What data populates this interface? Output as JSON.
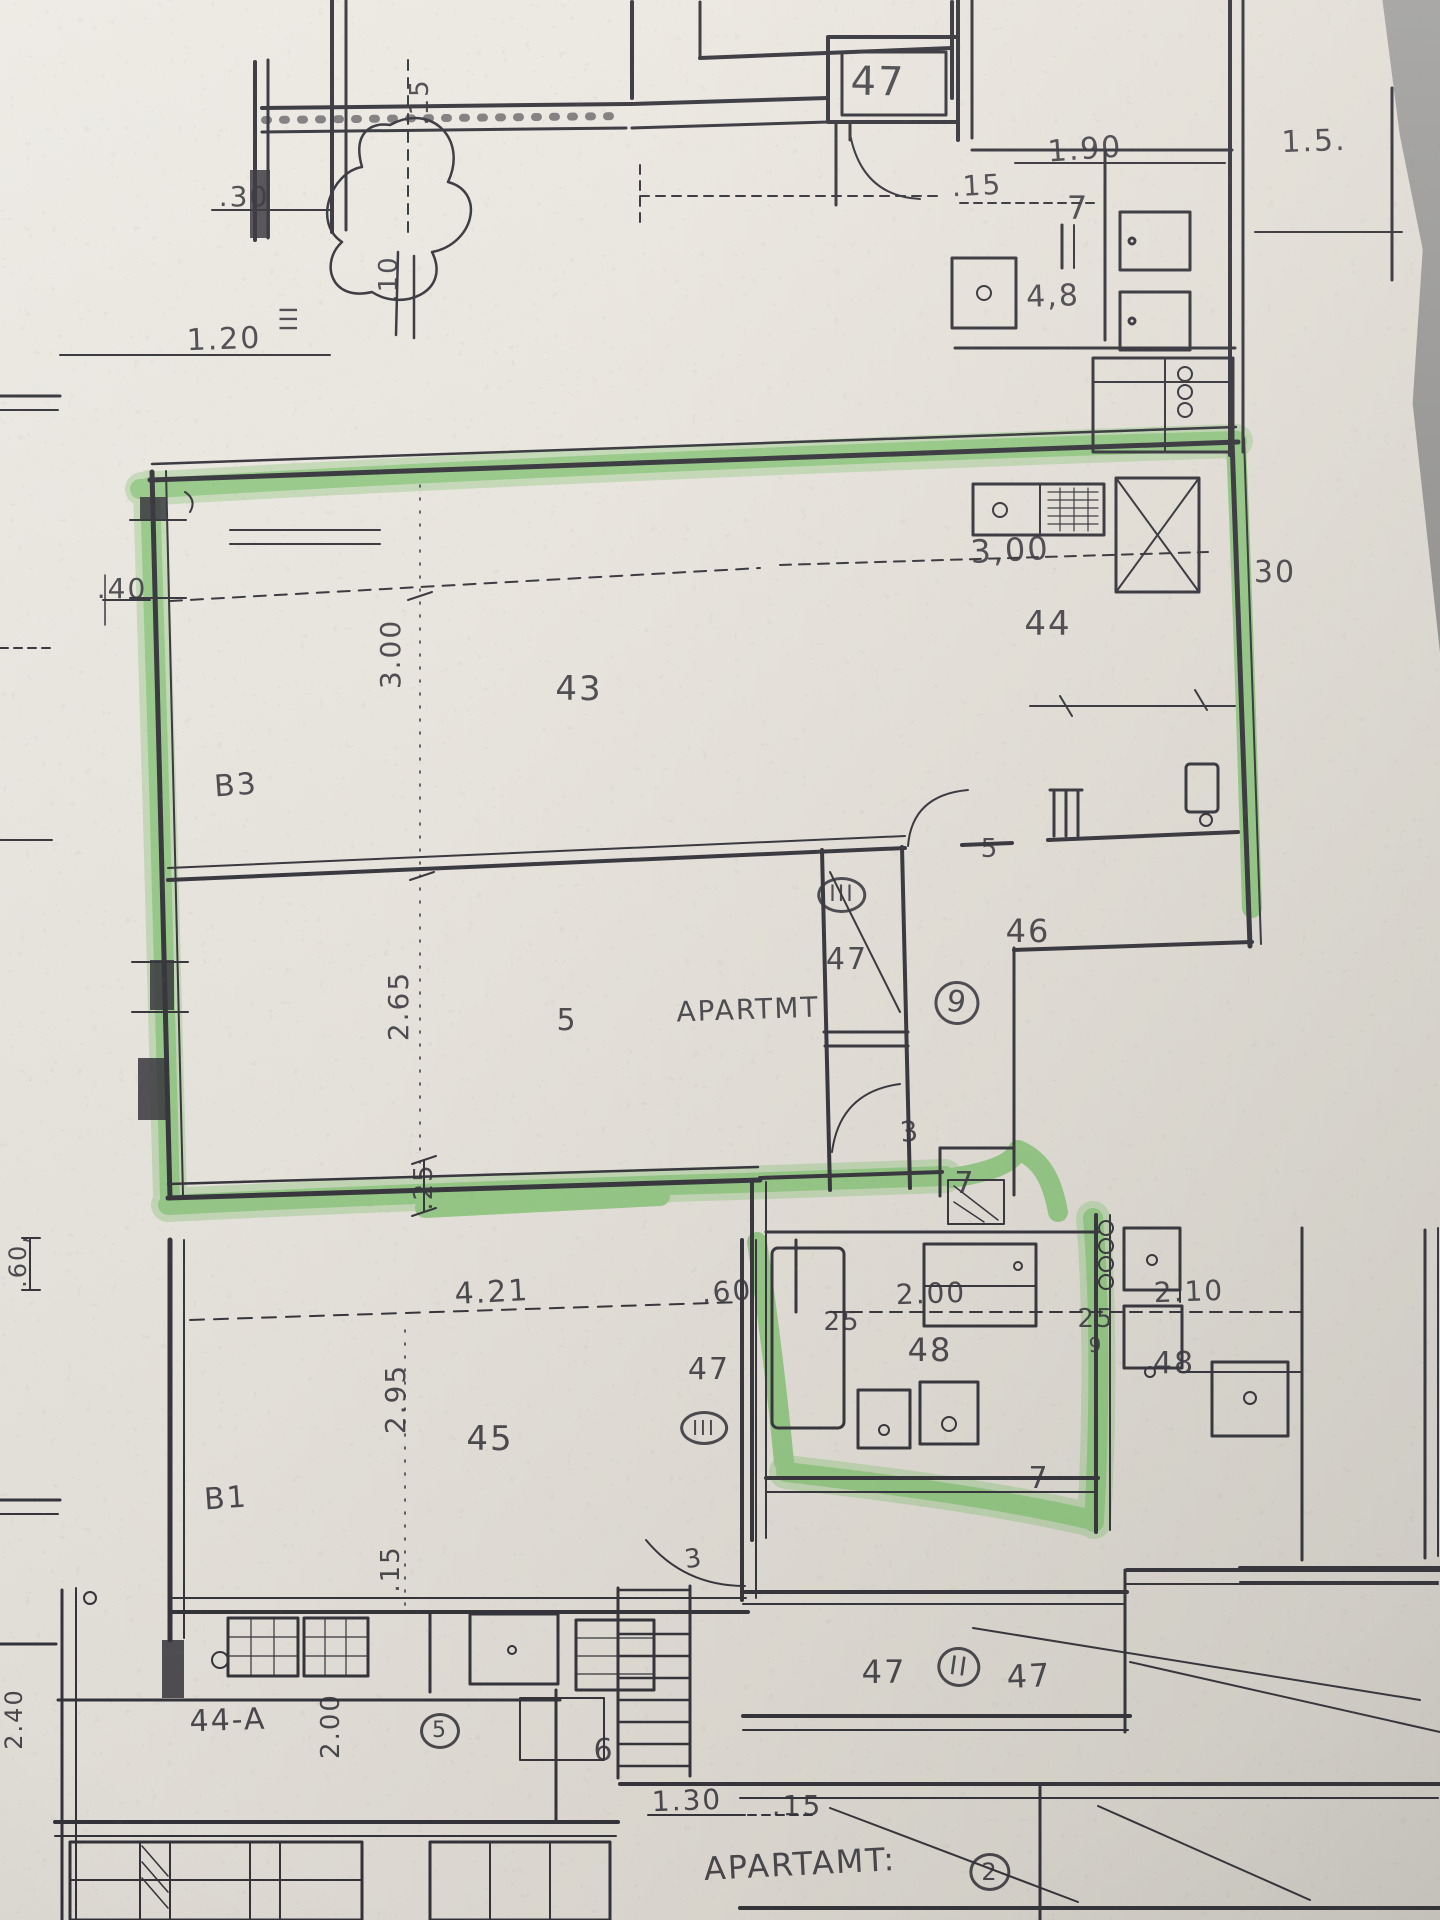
{
  "colors": {
    "ink": "#35343b",
    "highlighter": "#54b641",
    "paper": "#ece8e1",
    "table": "#8e8d8a"
  },
  "plan_labels": [
    {
      "text": "47",
      "x": 878,
      "y": 82,
      "size": 40,
      "rot": 1
    },
    {
      "text": "1.90",
      "x": 1085,
      "y": 150,
      "size": 30,
      "rot": -4
    },
    {
      "text": "1.5.",
      "x": 1314,
      "y": 142,
      "size": 30,
      "rot": -2
    },
    {
      "text": ".15",
      "x": 977,
      "y": 186,
      "size": 28,
      "rot": -3
    },
    {
      "text": "7",
      "x": 1078,
      "y": 208,
      "size": 32,
      "rot": 0
    },
    {
      "text": "4,8",
      "x": 1053,
      "y": 297,
      "size": 30,
      "rot": -2
    },
    {
      "text": ".30",
      "x": 244,
      "y": 197,
      "size": 28,
      "rot": 0
    },
    {
      "text": ".15",
      "x": 420,
      "y": 102,
      "size": 26,
      "rot": -90
    },
    {
      "text": "1.20",
      "x": 224,
      "y": 340,
      "size": 30,
      "rot": -2
    },
    {
      "text": ".10",
      "x": 389,
      "y": 279,
      "size": 26,
      "rot": -90
    },
    {
      "text": "III",
      "x": 289,
      "y": 318,
      "size": 24,
      "rot": -90
    },
    {
      "text": "3,00",
      "x": 1010,
      "y": 550,
      "size": 32,
      "rot": -3
    },
    {
      "text": "30",
      "x": 1275,
      "y": 573,
      "size": 30,
      "rot": 0
    },
    {
      "text": "44",
      "x": 1048,
      "y": 624,
      "size": 34,
      "rot": 0
    },
    {
      "text": ".40",
      "x": 122,
      "y": 589,
      "size": 28,
      "rot": 0
    },
    {
      "text": "3.00",
      "x": 391,
      "y": 654,
      "size": 28,
      "rot": -90
    },
    {
      "text": "43",
      "x": 579,
      "y": 689,
      "size": 34,
      "rot": 0
    },
    {
      "text": "B3",
      "x": 236,
      "y": 786,
      "size": 30,
      "rot": -4
    },
    {
      "text": "2.65",
      "x": 399,
      "y": 1006,
      "size": 28,
      "rot": -90
    },
    {
      "text": "5",
      "x": 990,
      "y": 849,
      "size": 26,
      "rot": 0
    },
    {
      "text": "46",
      "x": 1028,
      "y": 931,
      "size": 32,
      "rot": 0
    },
    {
      "text": "III",
      "x": 842,
      "y": 895,
      "size": 22,
      "rot": 0,
      "circled": true
    },
    {
      "text": "47",
      "x": 847,
      "y": 960,
      "size": 30,
      "rot": 0
    },
    {
      "text": "5",
      "x": 567,
      "y": 1021,
      "size": 30,
      "rot": 0
    },
    {
      "text": "APARTMT",
      "x": 748,
      "y": 1010,
      "size": 28,
      "rot": -2
    },
    {
      "text": "9",
      "x": 957,
      "y": 1003,
      "size": 30,
      "rot": 10,
      "circled": true
    },
    {
      "text": "3",
      "x": 910,
      "y": 1132,
      "size": 28,
      "rot": -6
    },
    {
      "text": "7",
      "x": 965,
      "y": 1184,
      "size": 30,
      "rot": 0
    },
    {
      "text": ".25",
      "x": 424,
      "y": 1187,
      "size": 26,
      "rot": -90
    },
    {
      "text": "4.21",
      "x": 492,
      "y": 1293,
      "size": 30,
      "rot": -3
    },
    {
      "text": ".60",
      "x": 727,
      "y": 1292,
      "size": 28,
      "rot": -4
    },
    {
      "text": "25",
      "x": 842,
      "y": 1322,
      "size": 26,
      "rot": 0
    },
    {
      "text": "2.00",
      "x": 931,
      "y": 1294,
      "size": 28,
      "rot": -2
    },
    {
      "text": "48",
      "x": 930,
      "y": 1350,
      "size": 32,
      "rot": 0
    },
    {
      "text": "25",
      "x": 1096,
      "y": 1319,
      "size": 26,
      "rot": 0
    },
    {
      "text": "2.10",
      "x": 1189,
      "y": 1292,
      "size": 28,
      "rot": -2
    },
    {
      "text": "9",
      "x": 1096,
      "y": 1345,
      "size": 20,
      "rot": 0
    },
    {
      "text": "48",
      "x": 1174,
      "y": 1364,
      "size": 30,
      "rot": 0
    },
    {
      "text": "47",
      "x": 709,
      "y": 1370,
      "size": 30,
      "rot": 0
    },
    {
      "text": "III",
      "x": 704,
      "y": 1428,
      "size": 20,
      "rot": 0,
      "circled": true
    },
    {
      "text": "2.95",
      "x": 396,
      "y": 1399,
      "size": 28,
      "rot": -90
    },
    {
      "text": "45",
      "x": 490,
      "y": 1439,
      "size": 34,
      "rot": 0
    },
    {
      "text": "B1",
      "x": 226,
      "y": 1499,
      "size": 30,
      "rot": -4
    },
    {
      "text": ".15",
      "x": 391,
      "y": 1569,
      "size": 26,
      "rot": -90
    },
    {
      "text": "7",
      "x": 1039,
      "y": 1479,
      "size": 30,
      "rot": 0
    },
    {
      "text": "3",
      "x": 694,
      "y": 1559,
      "size": 26,
      "rot": -8
    },
    {
      "text": "47",
      "x": 884,
      "y": 1672,
      "size": 32,
      "rot": 0
    },
    {
      "text": "II",
      "x": 959,
      "y": 1667,
      "size": 26,
      "rot": 8,
      "circled": true
    },
    {
      "text": "47",
      "x": 1029,
      "y": 1676,
      "size": 32,
      "rot": -3
    },
    {
      "text": "44-A",
      "x": 228,
      "y": 1721,
      "size": 30,
      "rot": -2
    },
    {
      "text": "2.00",
      "x": 331,
      "y": 1726,
      "size": 26,
      "rot": -90
    },
    {
      "text": "5",
      "x": 440,
      "y": 1731,
      "size": 22,
      "rot": 0,
      "circled": true
    },
    {
      "text": "6",
      "x": 604,
      "y": 1751,
      "size": 30,
      "rot": 0
    },
    {
      "text": "1.30",
      "x": 687,
      "y": 1801,
      "size": 28,
      "rot": -2
    },
    {
      "text": ".15",
      "x": 797,
      "y": 1806,
      "size": 28,
      "rot": 0
    },
    {
      "text": "APARTAMT:",
      "x": 800,
      "y": 1864,
      "size": 32,
      "rot": -3
    },
    {
      "text": "2",
      "x": 990,
      "y": 1872,
      "size": 24,
      "rot": 0,
      "circled": true
    },
    {
      "text": ".60,",
      "x": 18,
      "y": 1261,
      "size": 24,
      "rot": -90
    },
    {
      "text": "2.40",
      "x": 14,
      "y": 1719,
      "size": 24,
      "rot": -90
    }
  ]
}
